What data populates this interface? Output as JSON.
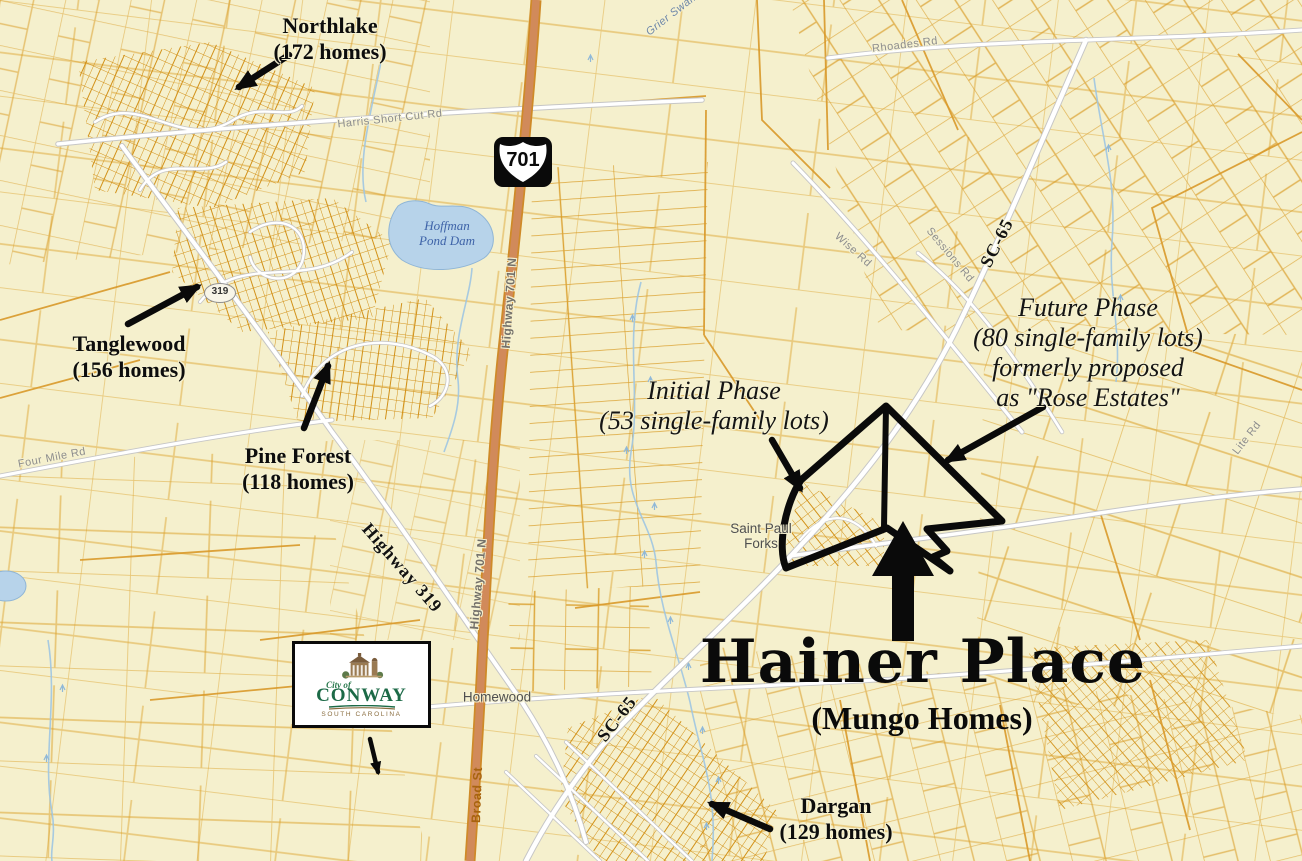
{
  "map_title": {
    "main": "Hainer Place",
    "sub": "(Mungo Homes)"
  },
  "callouts": {
    "northlake": {
      "name": "Northlake",
      "homes": "(172 homes)"
    },
    "tanglewood": {
      "name": "Tanglewood",
      "homes": "(156 homes)"
    },
    "pine_forest": {
      "name": "Pine Forest",
      "homes": "(118 homes)"
    },
    "dargan": {
      "name": "Dargan",
      "homes": "(129 homes)"
    }
  },
  "phases": {
    "initial": {
      "line1": "Initial Phase",
      "line2": "(53 single-family lots)"
    },
    "future": {
      "line1": "Future Phase",
      "line2": "(80 single-family lots)",
      "line3": "formerly proposed",
      "line4": "as \"Rose Estates\""
    }
  },
  "shields": {
    "us701": "701",
    "sc319": "319"
  },
  "road_labels": {
    "harris_short_cut": "Harris Short Cut Rd",
    "rhoades": "Rhoades Rd",
    "wise": "Wise Rd",
    "sessions": "Sessions Rd",
    "four_mile": "Four Mile Rd",
    "lite": "Lite Rd",
    "highway_319": "Highway 319",
    "highway_701n": "Highway 701 N",
    "broad_st": "Broad St",
    "sc65": "SC-65"
  },
  "place_labels": {
    "hoffman_pond": {
      "line1": "Hoffman",
      "line2": "Pond Dam"
    },
    "saint_paul_forks": {
      "line1": "Saint Paul",
      "line2": "Forks"
    },
    "homewood": "Homewood",
    "grier_swamp": "Grier Swamp"
  },
  "logo": {
    "city_of": "City of",
    "name": "CONWAY",
    "state": "SOUTH CAROLINA"
  },
  "colors": {
    "background": "#f5f0cd",
    "parcel_line": "#dd9b2a",
    "highway_701": "#d18a5a",
    "road_white": "#ffffff",
    "water": "#b7d3ea",
    "annotation": "#0d0d0d",
    "outline": "#0a0a0a"
  }
}
